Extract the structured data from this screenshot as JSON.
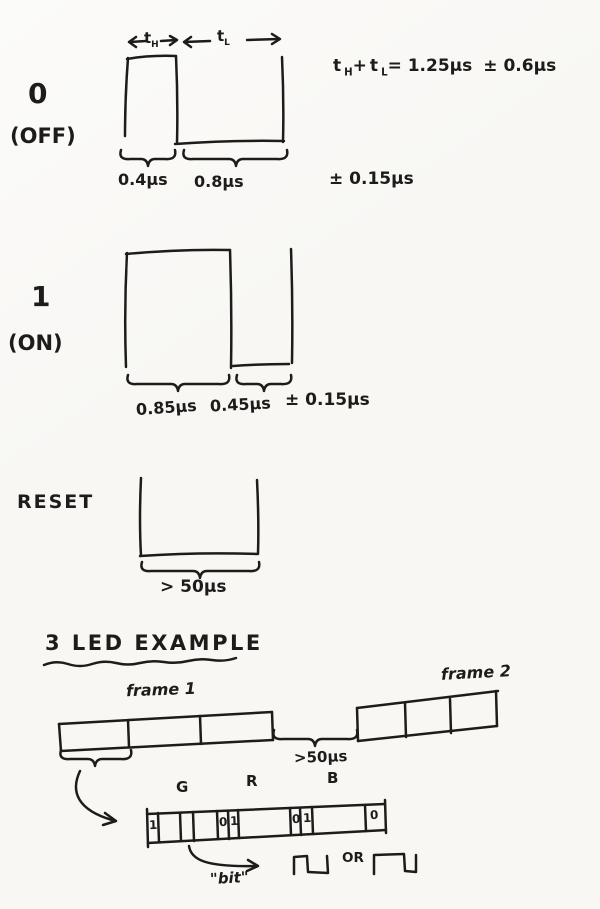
{
  "colors": {
    "paper": "#f8f7f4",
    "ink": "#1e1c1a"
  },
  "bit0": {
    "name_label": "0",
    "state_label": "(OFF)",
    "t_high": {
      "base": "t",
      "sub": "H"
    },
    "t_low": {
      "base": "t",
      "sub": "L"
    },
    "formula": {
      "t1": "t",
      "t1_sub": "H",
      "plus": "+",
      "t2": "t",
      "t2_sub": "L",
      "equals": "= 1.25μs",
      "tolerance": "± 0.6μs"
    },
    "high_time": "0.4μs",
    "low_time": "0.8μs",
    "tolerance": "± 0.15μs"
  },
  "bit1": {
    "name_label": "1",
    "state_label": "(ON)",
    "high_time": "0.85μs",
    "low_time": "0.45μs",
    "tolerance": "± 0.15μs"
  },
  "reset": {
    "label": "RESET",
    "min_time": "> 50μs"
  },
  "example": {
    "title": "3 LED EXAMPLE",
    "frame1_label": "frame 1",
    "frame2_label": "frame 2",
    "frame_gap_time": ">50μs",
    "channels": {
      "green": "G",
      "red": "R",
      "blue": "B"
    },
    "strip_bits": [
      "1",
      "0",
      "1",
      "0",
      "1",
      "0"
    ],
    "bit_label": "\"bit\"",
    "or_label": "OR"
  }
}
